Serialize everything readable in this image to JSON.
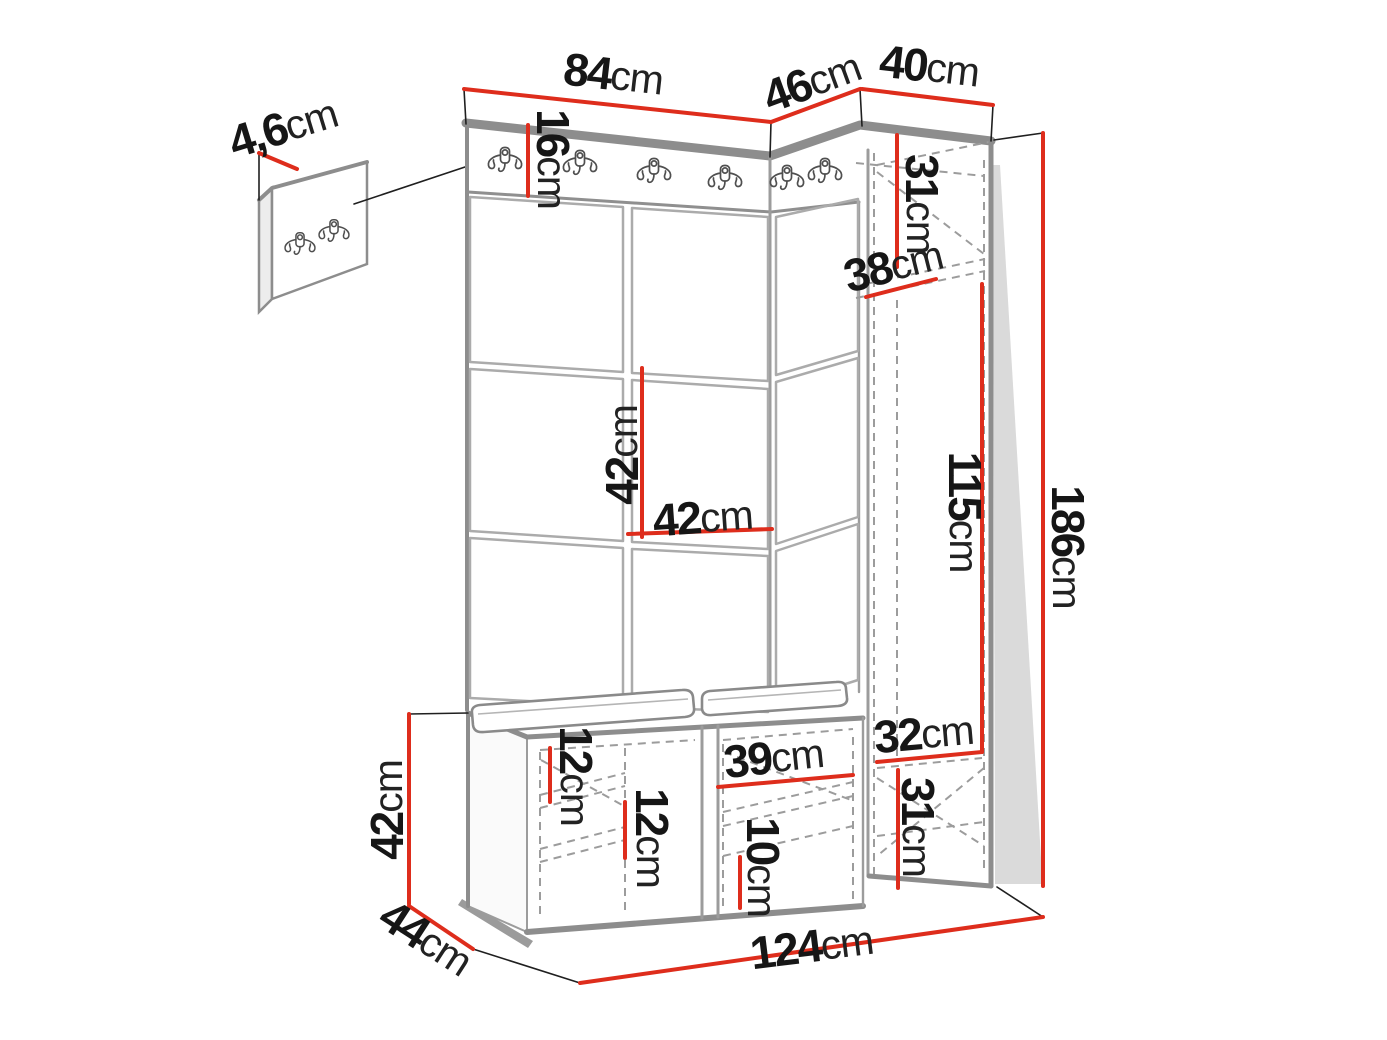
{
  "meta": {
    "type": "furniture-dimension-diagram",
    "description": "Hallway wardrobe set: wall hook panel detail, coat-hook strip, upholstered square panels, tall side cabinet and shoe bench with measurements",
    "unit_system": "cm"
  },
  "colors": {
    "dim_red": "#de2d1c",
    "edge_gray": "#8d8d8d",
    "grid_gray": "#ababab",
    "dash_gray": "#9c9c9c",
    "text_dark": "#161616"
  },
  "dims": {
    "panel_thickness": {
      "num": "4,6",
      "unit": "cm"
    },
    "top_left": {
      "num": "84",
      "unit": "cm"
    },
    "top_mid": {
      "num": "46",
      "unit": "cm"
    },
    "top_right": {
      "num": "40",
      "unit": "cm"
    },
    "strip_height": {
      "num": "16",
      "unit": "cm"
    },
    "cab_top": {
      "num": "31",
      "unit": "cm"
    },
    "cab_depth": {
      "num": "38",
      "unit": "cm"
    },
    "tile_height": {
      "num": "42",
      "unit": "cm"
    },
    "tile_width": {
      "num": "42",
      "unit": "cm"
    },
    "cab_inner": {
      "num": "115",
      "unit": "cm"
    },
    "total_height": {
      "num": "186",
      "unit": "cm"
    },
    "cab_inner_width": {
      "num": "32",
      "unit": "cm"
    },
    "cab_bottom": {
      "num": "31",
      "unit": "cm"
    },
    "bench_height": {
      "num": "42",
      "unit": "cm"
    },
    "bench_depth": {
      "num": "44",
      "unit": "cm"
    },
    "bench_shelf_top": {
      "num": "12",
      "unit": "cm"
    },
    "bench_shelf_mid": {
      "num": "12",
      "unit": "cm"
    },
    "bench_right_width": {
      "num": "39",
      "unit": "cm"
    },
    "bench_shelf_bottom": {
      "num": "10",
      "unit": "cm"
    },
    "total_width": {
      "num": "124",
      "unit": "cm"
    }
  }
}
